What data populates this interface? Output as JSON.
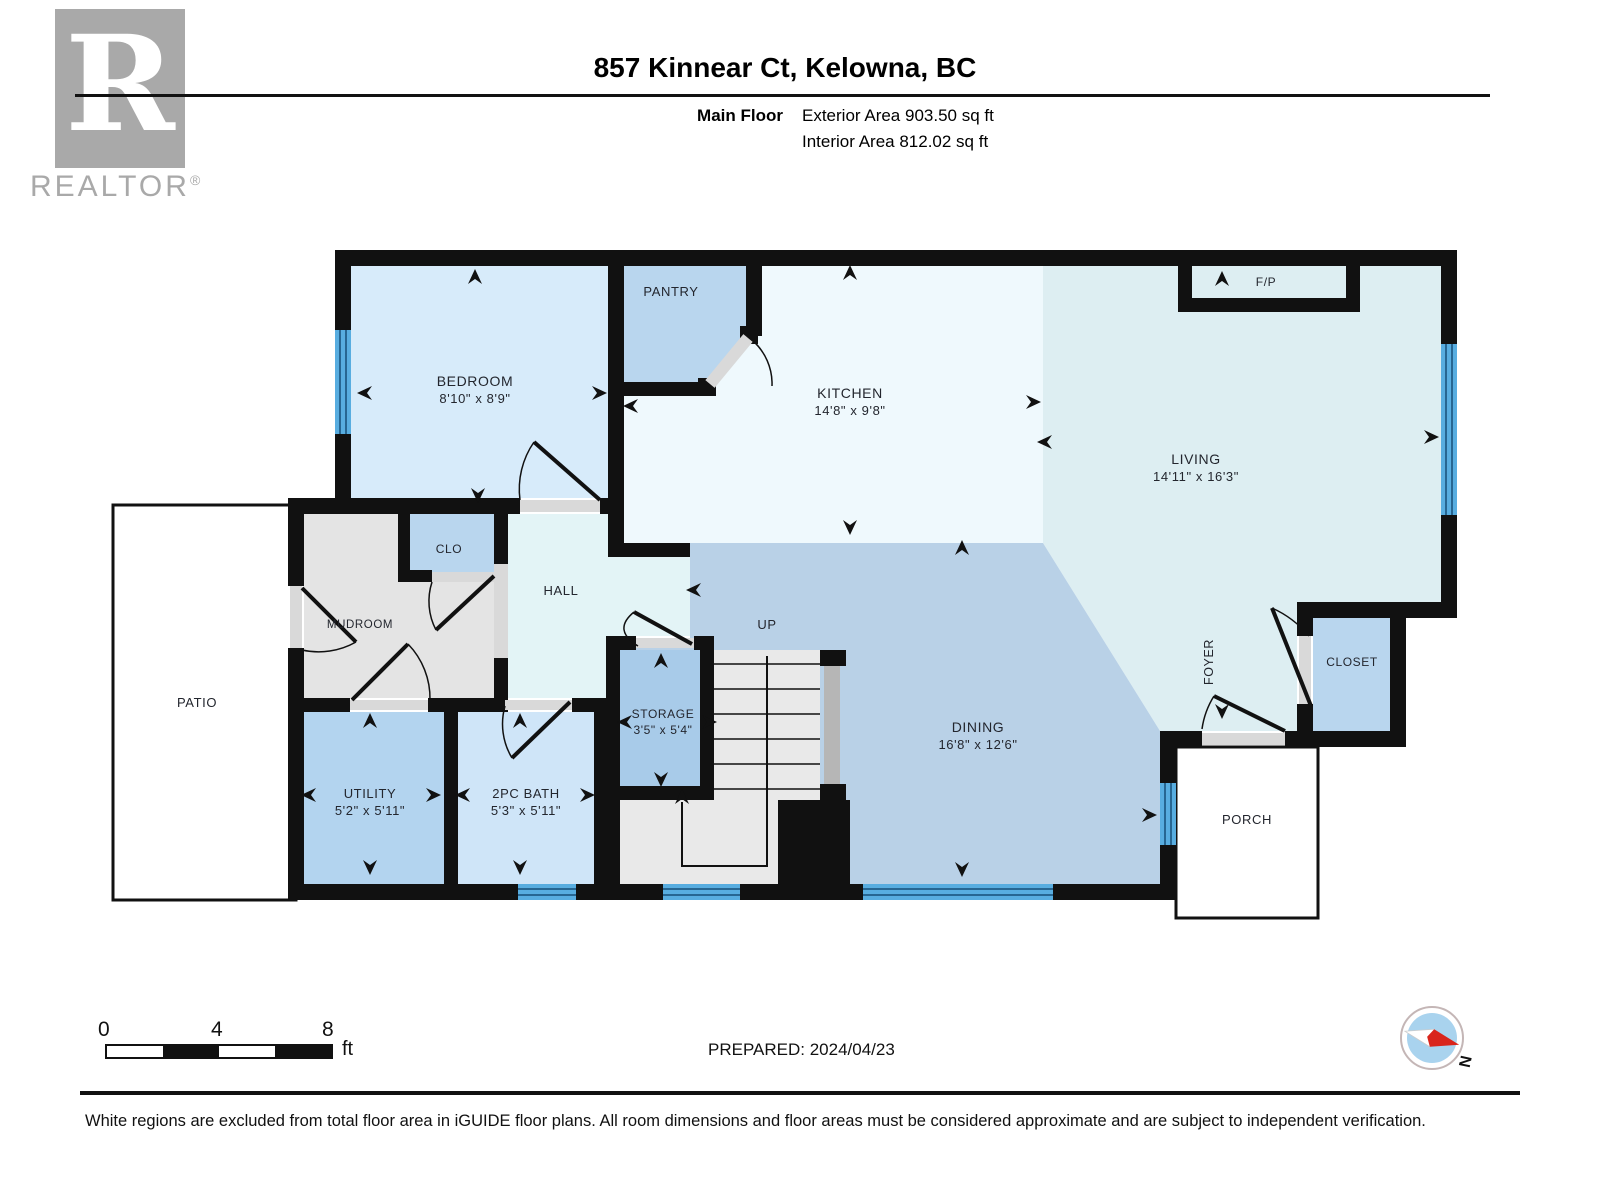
{
  "header": {
    "title": "857 Kinnear Ct, Kelowna, BC",
    "floor_label": "Main Floor",
    "exterior_area": "Exterior Area 903.50 sq ft",
    "interior_area": "Interior Area 812.02 sq ft"
  },
  "logo": {
    "letter": "R",
    "brand": "REALTOR",
    "registered": "®"
  },
  "plan": {
    "bedroom": {
      "name": "BEDROOM",
      "dims": "8'10\" x 8'9\""
    },
    "pantry": {
      "name": "PANTRY"
    },
    "kitchen": {
      "name": "KITCHEN",
      "dims": "14'8\" x 9'8\""
    },
    "living": {
      "name": "LIVING",
      "dims": "14'11\" x 16'3\""
    },
    "dining": {
      "name": "DINING",
      "dims": "16'8\" x 12'6\""
    },
    "fireplace": {
      "name": "F/P"
    },
    "hall": {
      "name": "HALL"
    },
    "mudroom": {
      "name": "MUDROOM"
    },
    "clo": {
      "name": "CLO"
    },
    "storage": {
      "name": "STORAGE",
      "dims": "3'5\" x 5'4\""
    },
    "utility": {
      "name": "UTILITY",
      "dims": "5'2\" x 5'11\""
    },
    "bath": {
      "name": "2PC BATH",
      "dims": "5'3\" x 5'11\""
    },
    "foyer": {
      "name": "FOYER"
    },
    "closet": {
      "name": "CLOSET"
    },
    "porch": {
      "name": "PORCH"
    },
    "patio": {
      "name": "PATIO"
    },
    "stairs": {
      "name": "UP"
    }
  },
  "footer": {
    "scale": {
      "tick0": "0",
      "tick4": "4",
      "tick8": "8",
      "unit": "ft"
    },
    "prepared": "PREPARED: 2024/04/23",
    "compass_north": "N",
    "disclaimer": "White regions are excluded from total floor area in iGUIDE floor plans. All room dimensions and floor areas must be considered approximate and are subject to independent verification."
  },
  "palette": {
    "wall": "#111111",
    "window_glass": "#58ade0",
    "window_mullion": "#174f79",
    "bedroom_fill": "#d7ebfa",
    "kitchen_fill": "#eff9fd",
    "living_fill": "#ddeef2",
    "dining_fill": "#b9d1e7",
    "hall_fill": "#e3f4f6",
    "closet_fill": "#b9d6ee",
    "storage_fill": "#a8cbe9",
    "utility_fill": "#b3d4ef",
    "bath_fill": "#cfe5f8",
    "mudroom_fill": "#e4e4e4",
    "stairs_fill": "#e9e9e9",
    "threshold": "#d9d9d9",
    "compass_red": "#d9251c",
    "logo_gray": "#a9a9a9"
  }
}
